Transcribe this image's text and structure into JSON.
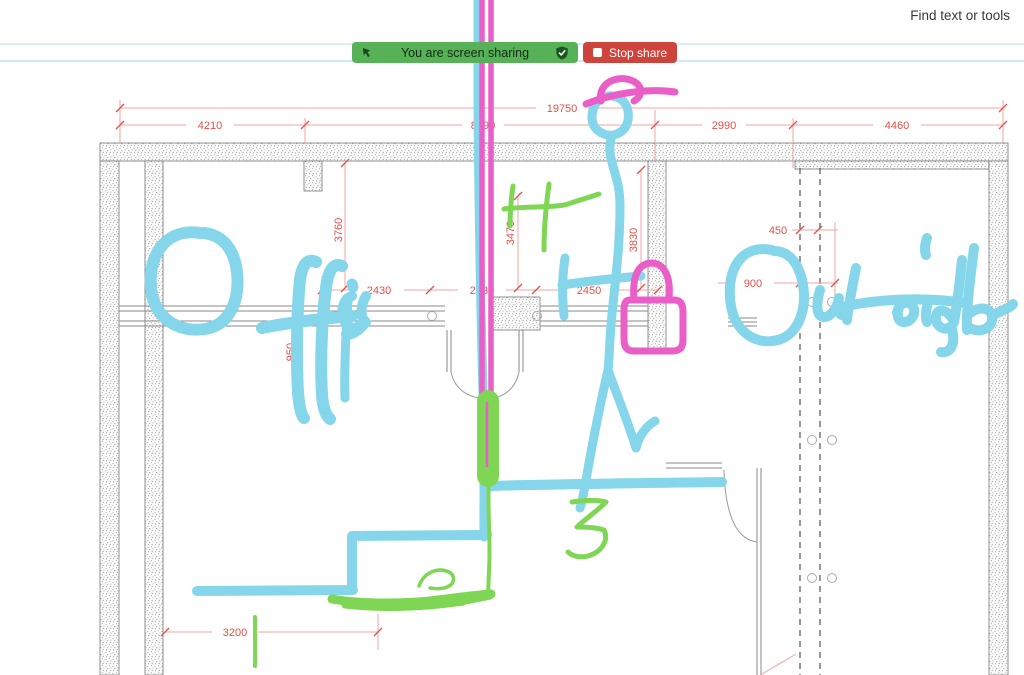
{
  "app": {
    "find_tools_label": "Find text or tools"
  },
  "share_banner": {
    "message": "You are screen sharing",
    "stop_button": "Stop share",
    "colors": {
      "banner_green": "#57b257",
      "stop_red": "#ce443d"
    }
  },
  "floor_plan": {
    "dimensions": {
      "overall_width": "19750",
      "top_row": [
        "4210",
        "8090",
        "2990",
        "4460"
      ],
      "middle_row": [
        "2430",
        "2430",
        "2450"
      ],
      "right_side": [
        "450",
        "900"
      ],
      "vertical": [
        "3760",
        "3470",
        "3830",
        "950"
      ],
      "bottom": "3200"
    },
    "dimension_color": "#e2504a"
  },
  "annotations": {
    "handwritten_words": [
      "Office",
      "Outside"
    ],
    "pen_colors": {
      "cyan": "#85d6ea",
      "magenta": "#ea5ec8",
      "green": "#7fd655"
    }
  }
}
